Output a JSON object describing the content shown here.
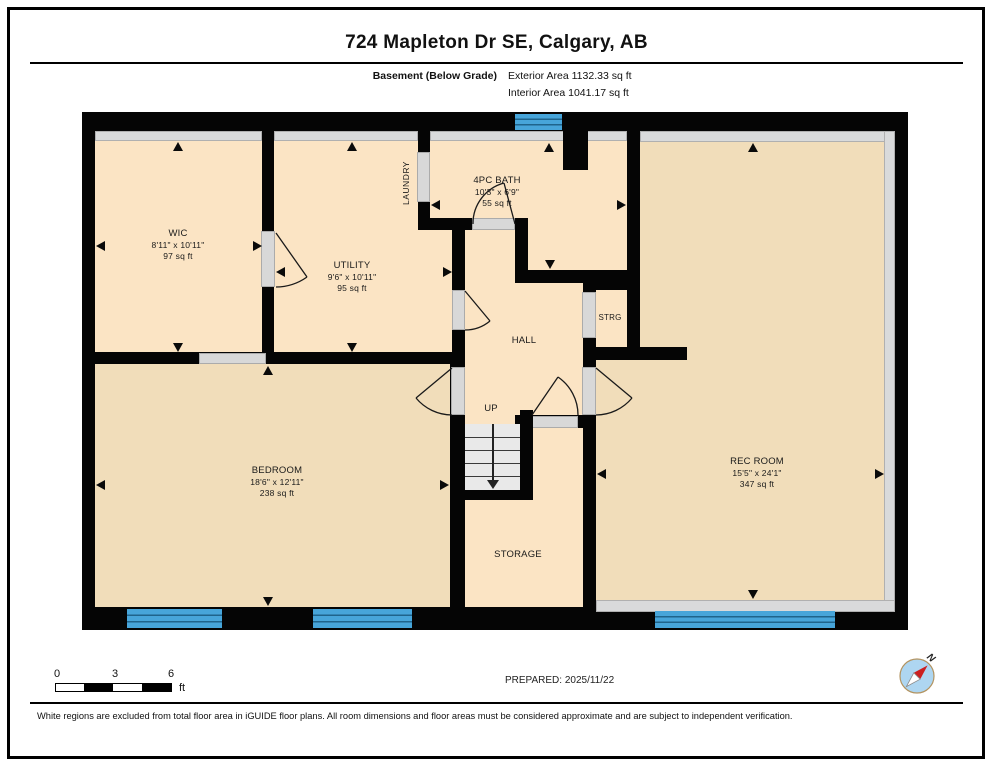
{
  "header": {
    "title": "724 Mapleton Dr SE, Calgary, AB",
    "floor_label": "Basement (Below Grade)",
    "exterior_area": "Exterior Area 1132.33 sq ft",
    "interior_area": "Interior Area 1041.17 sq ft"
  },
  "rooms": {
    "wic": {
      "name": "WIC",
      "dims": "8'11\" x 10'11\"",
      "area": "97 sq ft"
    },
    "utility": {
      "name": "UTILITY",
      "dims": "9'6\" x 10'11\"",
      "area": "95 sq ft"
    },
    "laundry": {
      "name": "LAUNDRY"
    },
    "bath": {
      "name": "4PC BATH",
      "dims": "10'3\" x 6'9\"",
      "area": "55 sq ft"
    },
    "hall": {
      "name": "HALL"
    },
    "up": {
      "name": "UP"
    },
    "strg": {
      "name": "STRG"
    },
    "storage": {
      "name": "STORAGE"
    },
    "bedroom": {
      "name": "BEDROOM",
      "dims": "18'6\" x 12'11\"",
      "area": "238 sq ft"
    },
    "rec": {
      "name": "REC ROOM",
      "dims": "15'5\" x 24'1\"",
      "area": "347 sq ft"
    }
  },
  "footer": {
    "prepared": "PREPARED: 2025/11/22",
    "scale": {
      "start": "0",
      "mid": "3",
      "end": "6",
      "unit": "ft"
    },
    "compass_n": "N",
    "disclaimer": "White regions are excluded from total floor area in iGUIDE floor plans. All room dimensions and floor areas must be considered approximate and are subject to independent verification."
  },
  "colors": {
    "room_light": "#fbe4c4",
    "room_dark": "#f1ddba",
    "wall": "#050505",
    "window_blue": "#47a5da"
  }
}
